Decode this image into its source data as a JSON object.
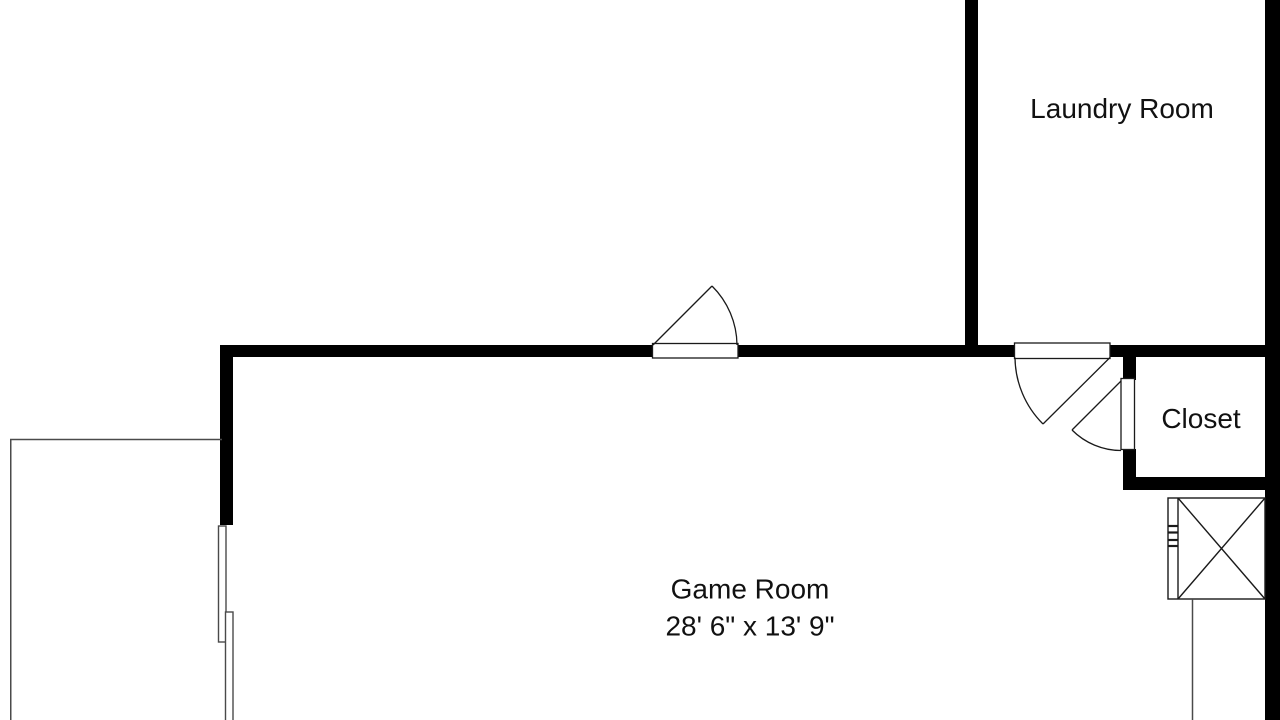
{
  "rooms": {
    "laundry": {
      "label": "Laundry Room"
    },
    "closet": {
      "label": "Closet"
    },
    "game_room": {
      "label": "Game Room",
      "dimensions": "28' 6\" x 13' 9\""
    }
  },
  "colors": {
    "background": "#ffffff",
    "wall": "#000000",
    "door_line": "#1a1a1a",
    "thin_line": "#4a4a4a",
    "text": "#111111"
  }
}
